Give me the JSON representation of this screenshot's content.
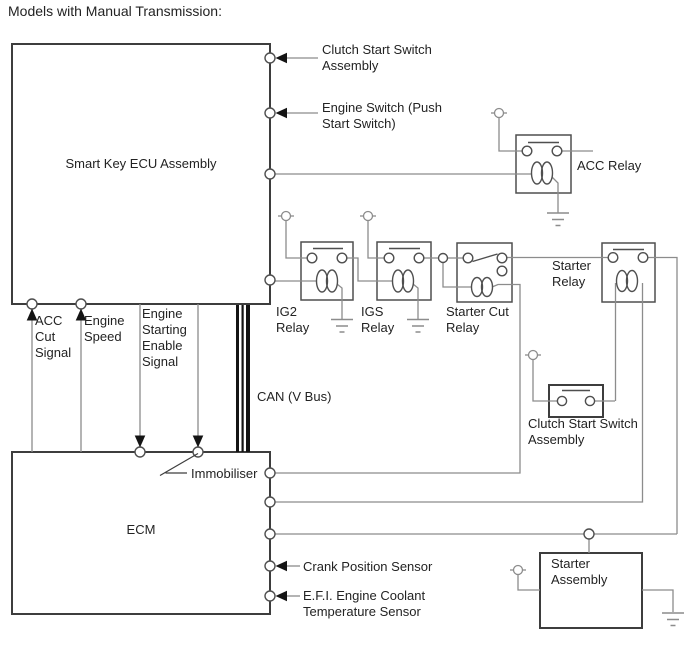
{
  "title": "Models with Manual Transmission:",
  "colors": {
    "wire": "#8c8c8c",
    "component_stroke": "#4f4f4f",
    "block_stroke": "#3d3d3d",
    "arrow": "#141414",
    "text": "#232323",
    "background": "#ffffff"
  },
  "blocks": {
    "smart_key_ecu": "Smart Key ECU Assembly",
    "ecm": "ECM",
    "starter_assembly": "Starter\nAssembly"
  },
  "relays": {
    "acc": "ACC Relay",
    "ig2": "IG2\nRelay",
    "igs": "IGS\nRelay",
    "starter_cut": "Starter Cut\nRelay",
    "starter": "Starter\nRelay"
  },
  "signals": {
    "acc_cut": "ACC\nCut\nSignal",
    "engine_speed": "Engine\nSpeed",
    "engine_starting_enable": "Engine\nStarting\nEnable\nSignal",
    "immobiliser": "Immobiliser",
    "can_bus": "CAN (V Bus)"
  },
  "connections": {
    "clutch_start_switch_top": "Clutch Start Switch\nAssembly",
    "engine_switch": "Engine Switch (Push\nStart Switch)",
    "clutch_start_switch_mid": "Clutch Start Switch\nAssembly",
    "crank_position_sensor": "Crank Position Sensor",
    "efi_coolant_sensor": "E.F.I. Engine Coolant\nTemperature Sensor"
  }
}
